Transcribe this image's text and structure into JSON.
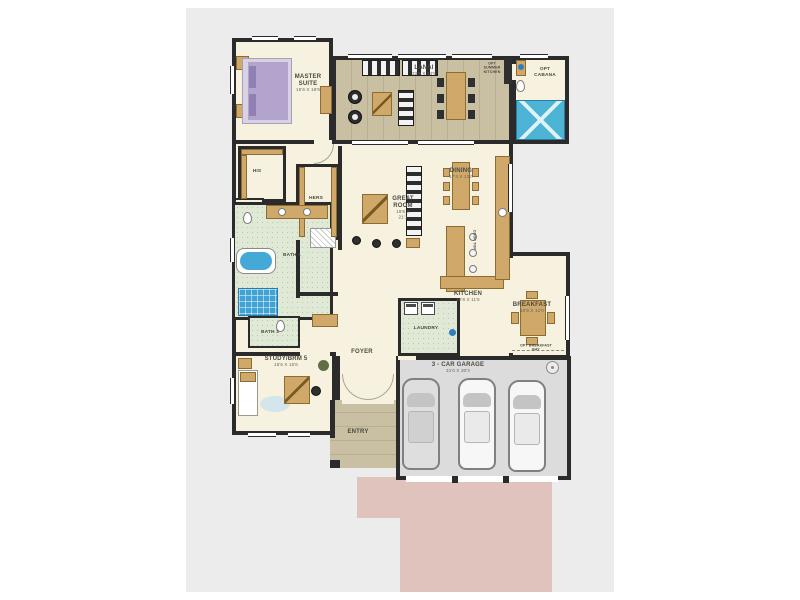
{
  "plan": {
    "rooms": {
      "master_suite": {
        "label": "MASTER SUITE",
        "dims": "16'6 X 18'9"
      },
      "lanai": {
        "label": "LANAI",
        "dims": "32'6 X 14'5"
      },
      "opt_cabana": {
        "label": "OPT CABANA"
      },
      "opt_summer_kitchen": {
        "label": "OPT SUMMER KITCHEN"
      },
      "his_closet": {
        "label": "HIS"
      },
      "hers_closet": {
        "label": "HERS"
      },
      "bath_1": {
        "label": "BATH 1"
      },
      "bath_3": {
        "label": "BATH 3"
      },
      "great_room": {
        "label": "GREAT ROOM",
        "dims": "19'6 X 21'1"
      },
      "dining": {
        "label": "DINING",
        "dims": "17'4 X 13'0"
      },
      "kitchen": {
        "label": "KITCHEN",
        "dims": "19'8 X 11'5"
      },
      "cook_top": {
        "label": "COOK TOP"
      },
      "breakfast": {
        "label": "BREAKFAST",
        "dims": "10'8 X 12'0"
      },
      "opt_breakfast_bay": {
        "label": "OPT BREAKFAST BAY"
      },
      "laundry": {
        "label": "LAUNDRY"
      },
      "study": {
        "label": "STUDY/BRM 5",
        "dims": "15'6 X 15'6"
      },
      "foyer": {
        "label": "FOYER"
      },
      "entry": {
        "label": "ENTRY"
      },
      "garage": {
        "label": "3 - CAR GARAGE",
        "dims": "31'0 X 30'3"
      }
    },
    "colors": {
      "wall": "#2b2b2b",
      "floor_cream": "#f7f2df",
      "floor_outdoor": "#c9c0a3",
      "floor_tile": "#dfe9d5",
      "floor_garage": "#dcdcdc",
      "driveway": "#dfc3bc",
      "water_blue": "#45a9d6",
      "furniture_tan": "#d0a869",
      "bed_purple": "#b2a4cc",
      "canvas": "#ececec"
    }
  }
}
